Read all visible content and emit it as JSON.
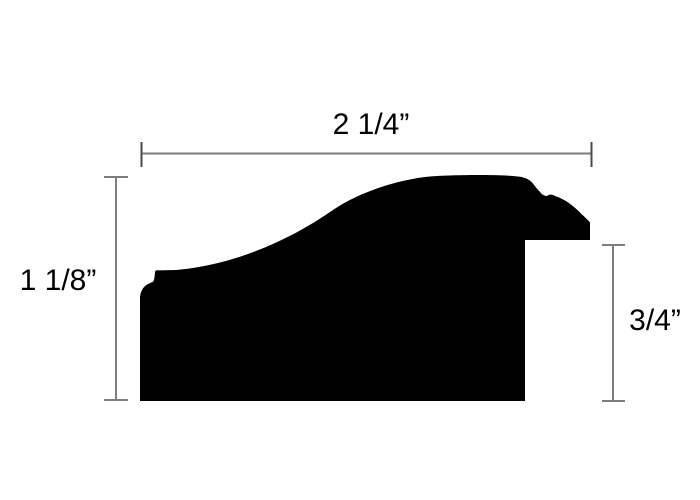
{
  "diagram": {
    "kind": "moulding-profile-cross-section",
    "colors": {
      "background": "#ffffff",
      "silhouette": "#000000",
      "dimension_line": "#7d7d7d",
      "dimension_end_tick": "#4a4a4a",
      "label_text": "#000000"
    },
    "dimensions": {
      "width": {
        "label": "2 1/4”",
        "position": "top"
      },
      "height": {
        "label": "1 1/8”",
        "position": "left"
      },
      "rabbet": {
        "label": "3/4”",
        "position": "right"
      }
    }
  }
}
